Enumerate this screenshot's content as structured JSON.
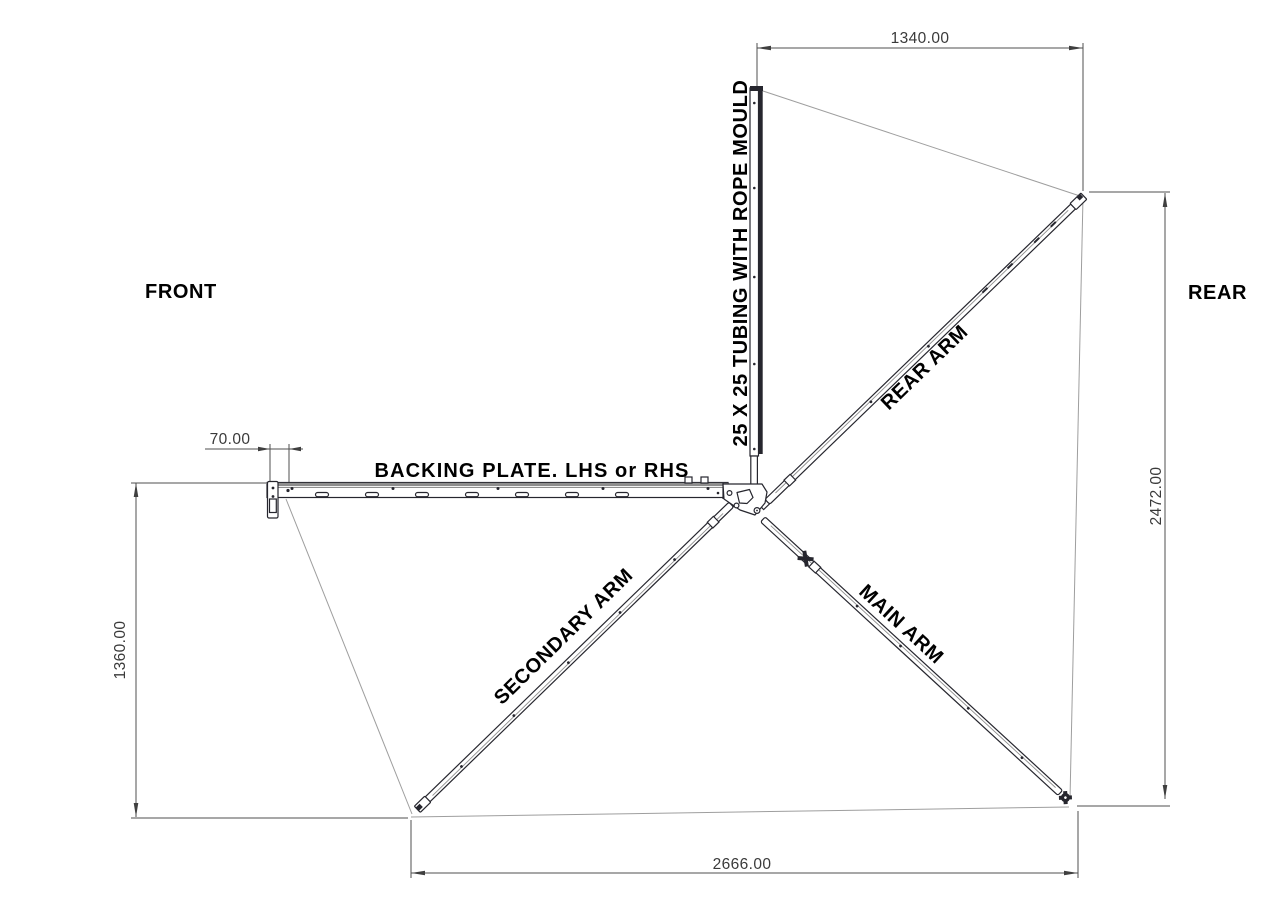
{
  "view_labels": {
    "front": "FRONT",
    "rear": "REAR"
  },
  "part_labels": {
    "backing_plate": "BACKING PLATE. LHS or RHS",
    "tube": "25 X 25 TUBING WITH ROPE MOULD",
    "rear_arm": "REAR ARM",
    "main_arm": "MAIN ARM",
    "secondary_arm": "SECONDARY ARM"
  },
  "dimensions": {
    "top_width": "1340.00",
    "rear_height": "2472.00",
    "front_height": "1360.00",
    "bottom_width": "2666.00",
    "plate_offset": "70.00"
  },
  "colors": {
    "background": "#ffffff",
    "part_outline": "#26262e",
    "dimension_line": "#4f4f4f",
    "dimension_text": "#3a3a3a",
    "label_text": "#000000",
    "fabric_edge": "#9e9e9e",
    "plate_top_edge": "#8e8e8e"
  }
}
